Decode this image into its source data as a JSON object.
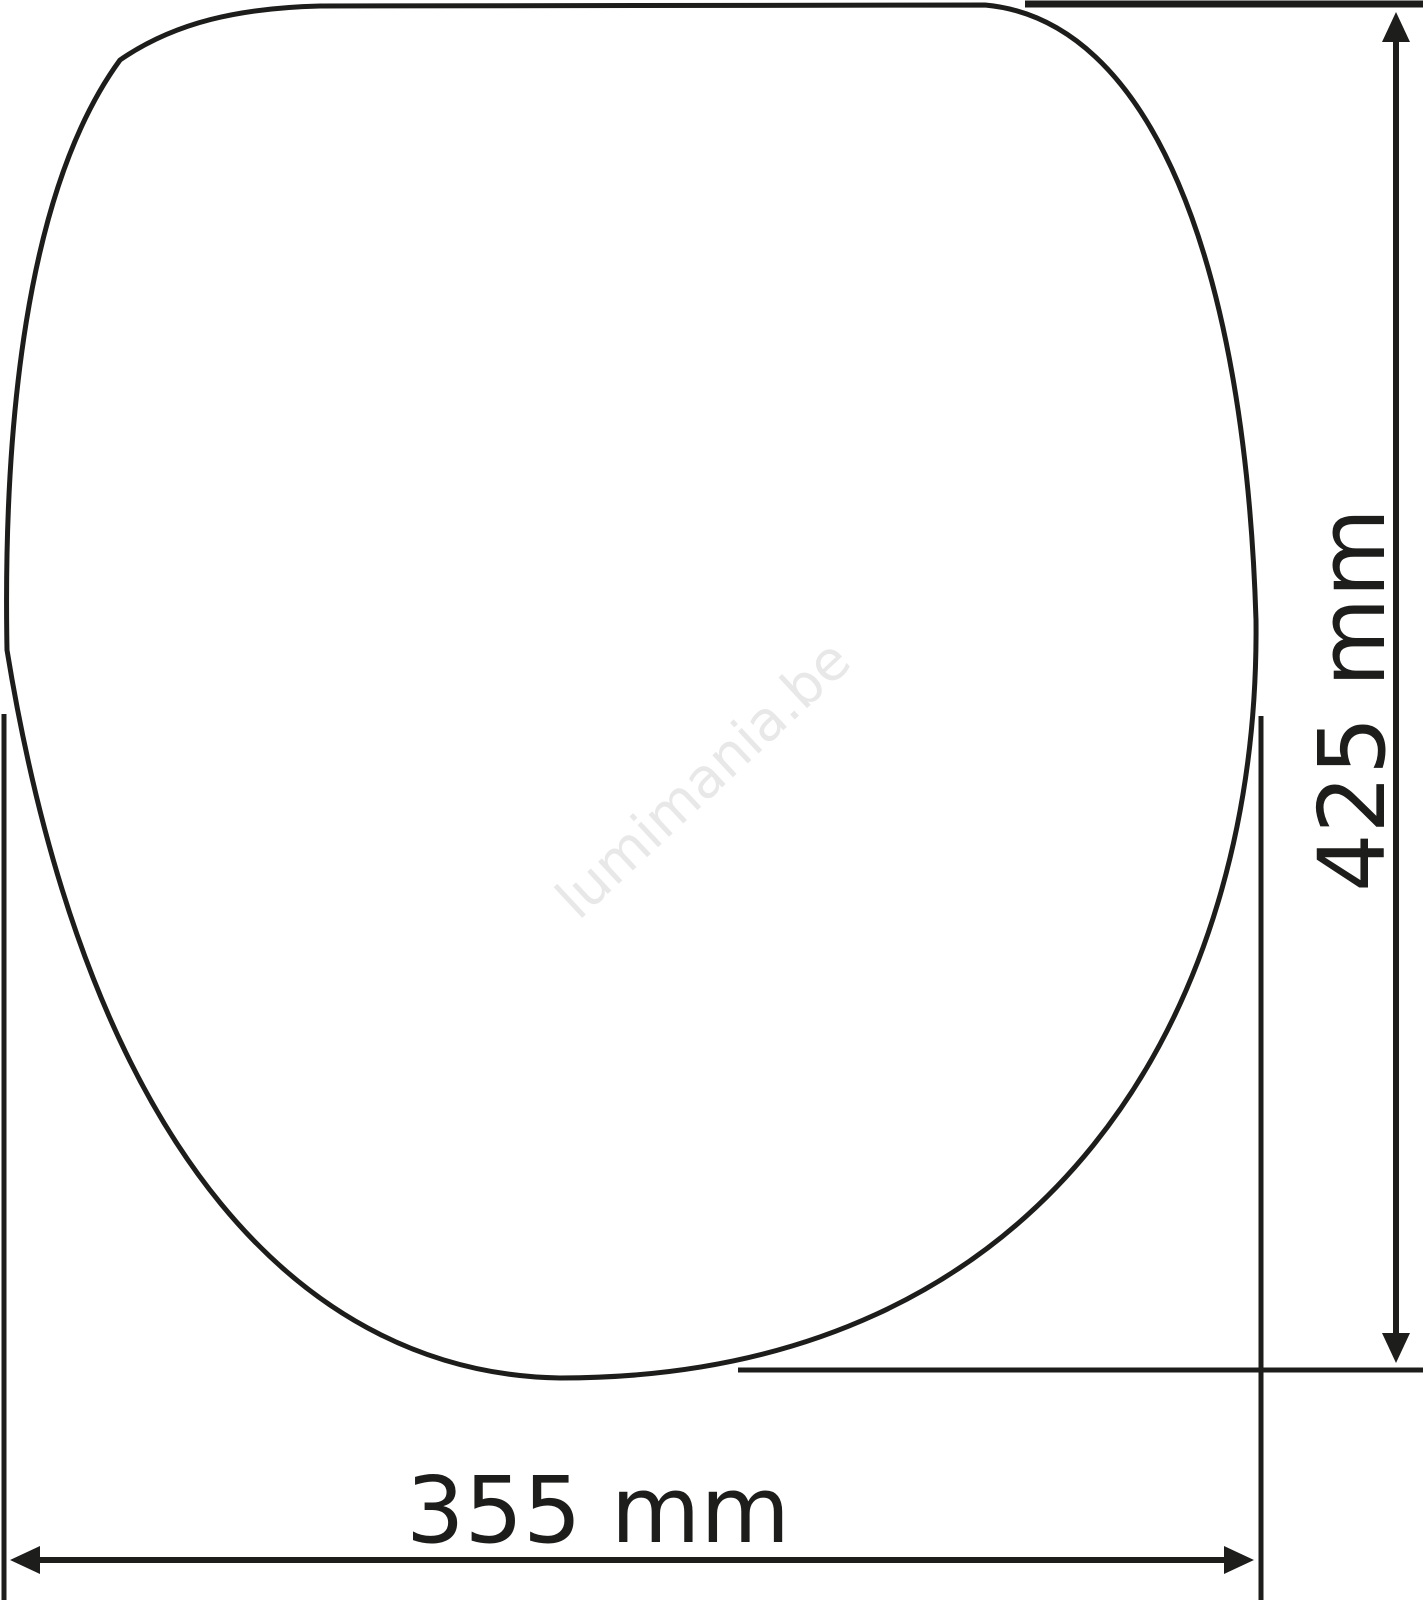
{
  "diagram": {
    "type": "technical-dimension-drawing",
    "subject": "toilet-seat-outline-top-view",
    "dimensions": {
      "height": {
        "label": "425 mm",
        "value": 425,
        "unit": "mm",
        "orientation": "vertical"
      },
      "width": {
        "label": "355 mm",
        "value": 355,
        "unit": "mm",
        "orientation": "horizontal"
      }
    },
    "watermark": {
      "text": "lumimania.be"
    },
    "colors": {
      "line": "#1d1d1b",
      "text": "#1d1d1b",
      "watermark": "#e8e8e8",
      "background": "#ffffff"
    }
  }
}
